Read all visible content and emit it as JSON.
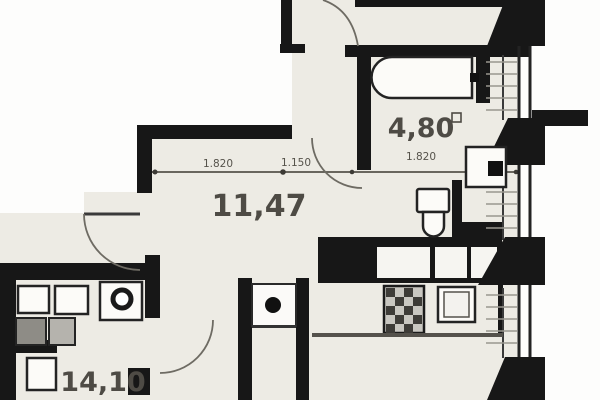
{
  "meta": {
    "type": "apartment-floor-plan"
  },
  "colors": {
    "background": "#fdfdfc",
    "floor": "#edebe4",
    "wall": "#171717",
    "dimension": "#56534b",
    "label_text": "#4e4b45"
  },
  "rooms": [
    {
      "id": "bathroom",
      "label": "4,80"
    },
    {
      "id": "hallway",
      "label": "11,47"
    },
    {
      "id": "kitchen",
      "label": "14,10"
    }
  ],
  "dimensions": [
    {
      "id": "left",
      "label": "1.820"
    },
    {
      "id": "middle",
      "label": "1.150"
    },
    {
      "id": "right",
      "label": "1.820"
    }
  ],
  "icons": [
    "bathtub-icon",
    "toilet-icon",
    "washing-machine-icon",
    "kitchen-sink-icon",
    "stove-icon",
    "cabinet-icon",
    "vent-shaft-icon",
    "utility-sink-icon",
    "door-arc-icon",
    "column-icon",
    "area-unit-icon"
  ]
}
